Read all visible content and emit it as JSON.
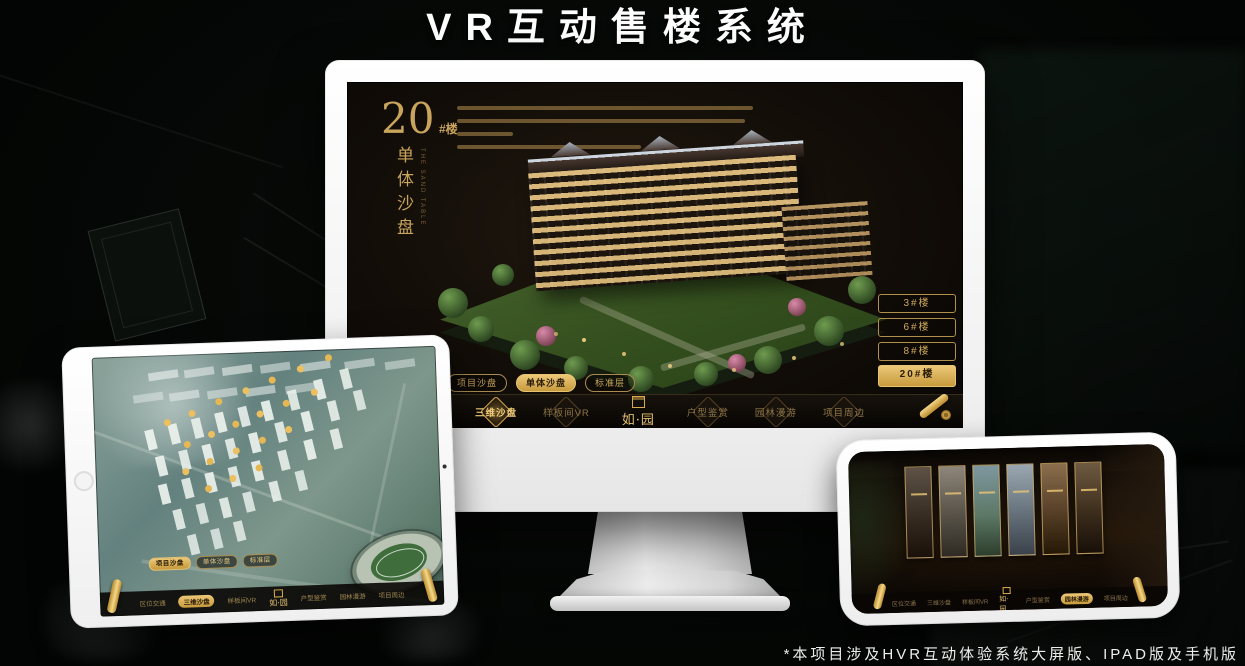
{
  "page": {
    "title": "VR互动售楼系统",
    "footnote": "*本项目涉及HVR互动体验系统大屏版、IPAD版及手机版"
  },
  "colors": {
    "gold": "#c9a45c",
    "gold_bright": "#ecc878",
    "screen_bg": "#0d0a07",
    "device_white": "#f5f5f5"
  },
  "sandbox": {
    "block_number": "20",
    "block_number_suffix": "#楼",
    "block_title": "单体沙盘",
    "block_title_en": "THE SAND TABLE",
    "floor_buttons": [
      {
        "label": "3#楼",
        "active": false
      },
      {
        "label": "6#楼",
        "active": false
      },
      {
        "label": "8#楼",
        "active": false
      },
      {
        "label": "20#楼",
        "active": true
      }
    ],
    "sub_tabs": [
      {
        "label": "项目沙盘"
      },
      {
        "label": "单体沙盘"
      },
      {
        "label": "标准层"
      }
    ],
    "monitor_active_sub_tab": "单体沙盘",
    "tablet_active_sub_tab": "项目沙盘"
  },
  "nav": {
    "items": [
      "区位交通",
      "三维沙盘",
      "样板间VR",
      "户型鉴赏",
      "园林漫游",
      "项目周边"
    ],
    "logo": "如·园",
    "monitor_active": "三维沙盘",
    "tablet_active": "三维沙盘",
    "phone_active": "园林漫游"
  }
}
